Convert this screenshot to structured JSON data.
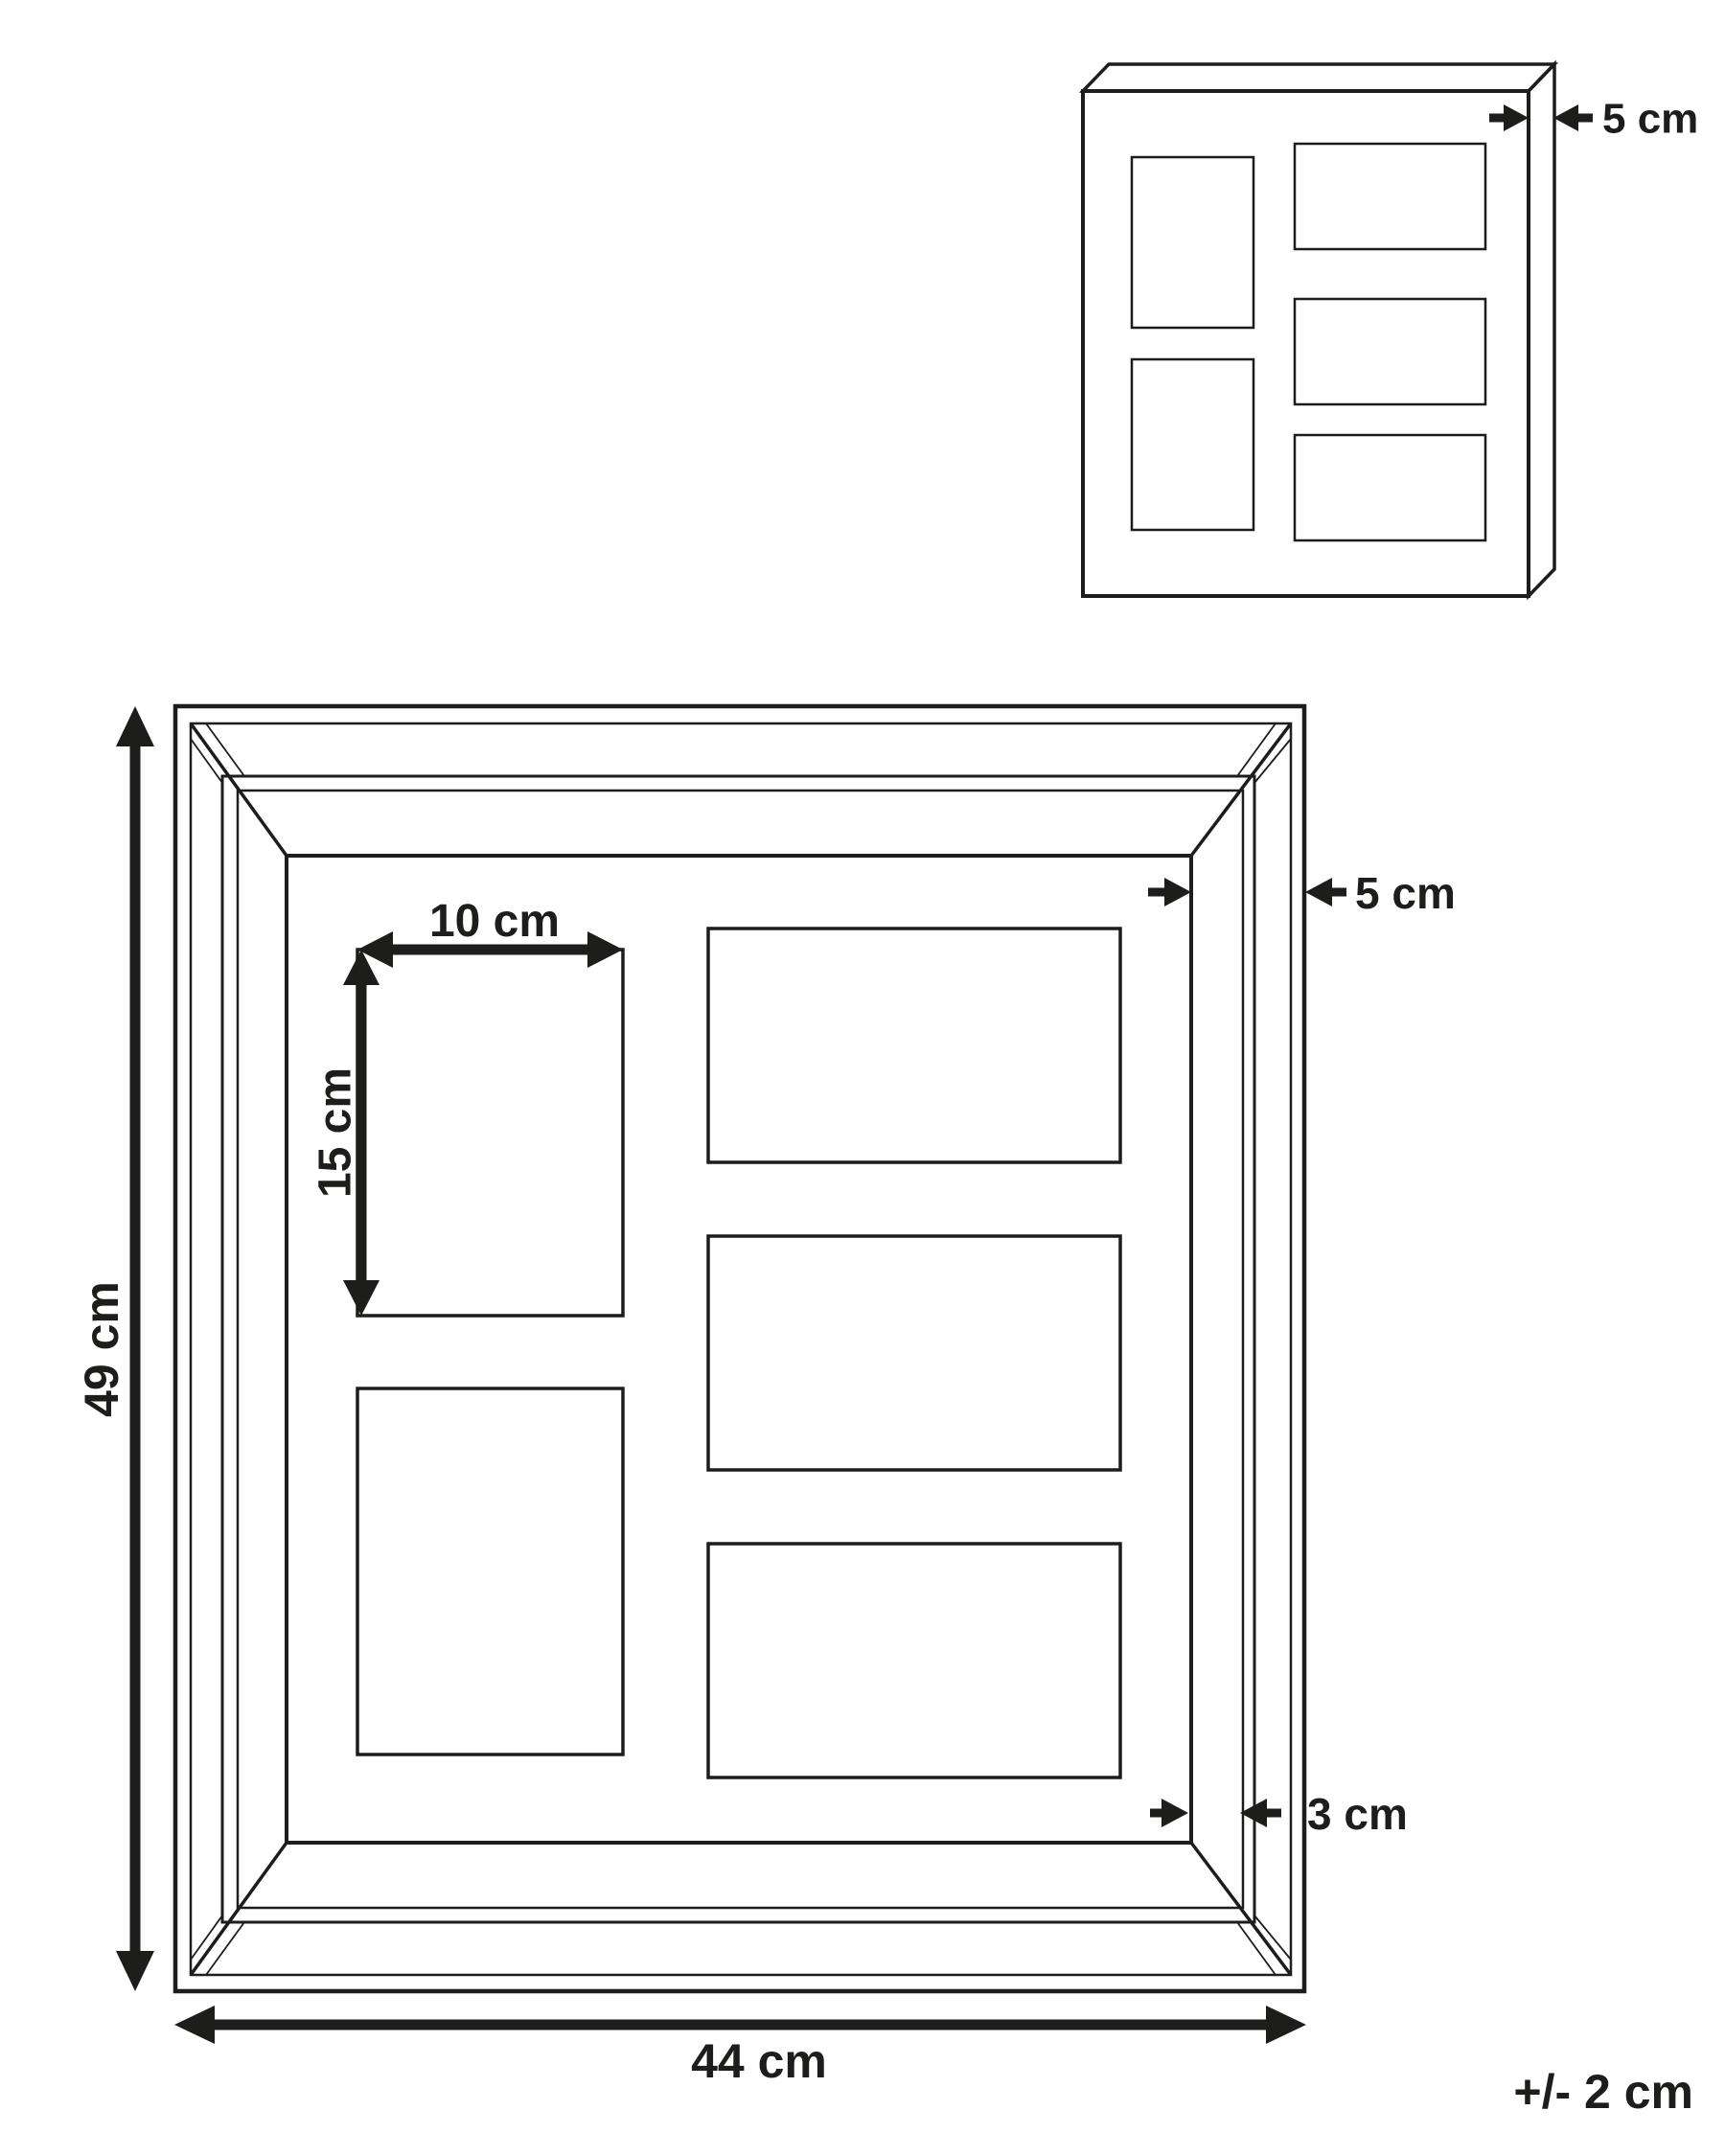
{
  "diagram": {
    "title": "Collage photo frame dimension drawing",
    "views": {
      "perspective_view": "frame shown in 3D with depth",
      "front_view": "frame front elevation with dimensions"
    },
    "labels": {
      "depth": "5 cm",
      "frame_border": "5 cm",
      "inner_border": "3 cm",
      "photo_width": "10 cm",
      "photo_height": "15 cm",
      "overall_height": "49 cm",
      "overall_width": "44 cm",
      "tolerance": "+/- 2 cm"
    },
    "dimensions_cm": {
      "overall_width": 44,
      "overall_height": 49,
      "depth": 5,
      "frame_border_width": 5,
      "inner_border_width": 3,
      "photo_width": 10,
      "photo_height": 15
    },
    "photo_slots": {
      "total": 5,
      "portrait_count": 2,
      "landscape_count": 3
    },
    "colors": {
      "line": "#1d1d1b",
      "background": "#ffffff"
    }
  }
}
